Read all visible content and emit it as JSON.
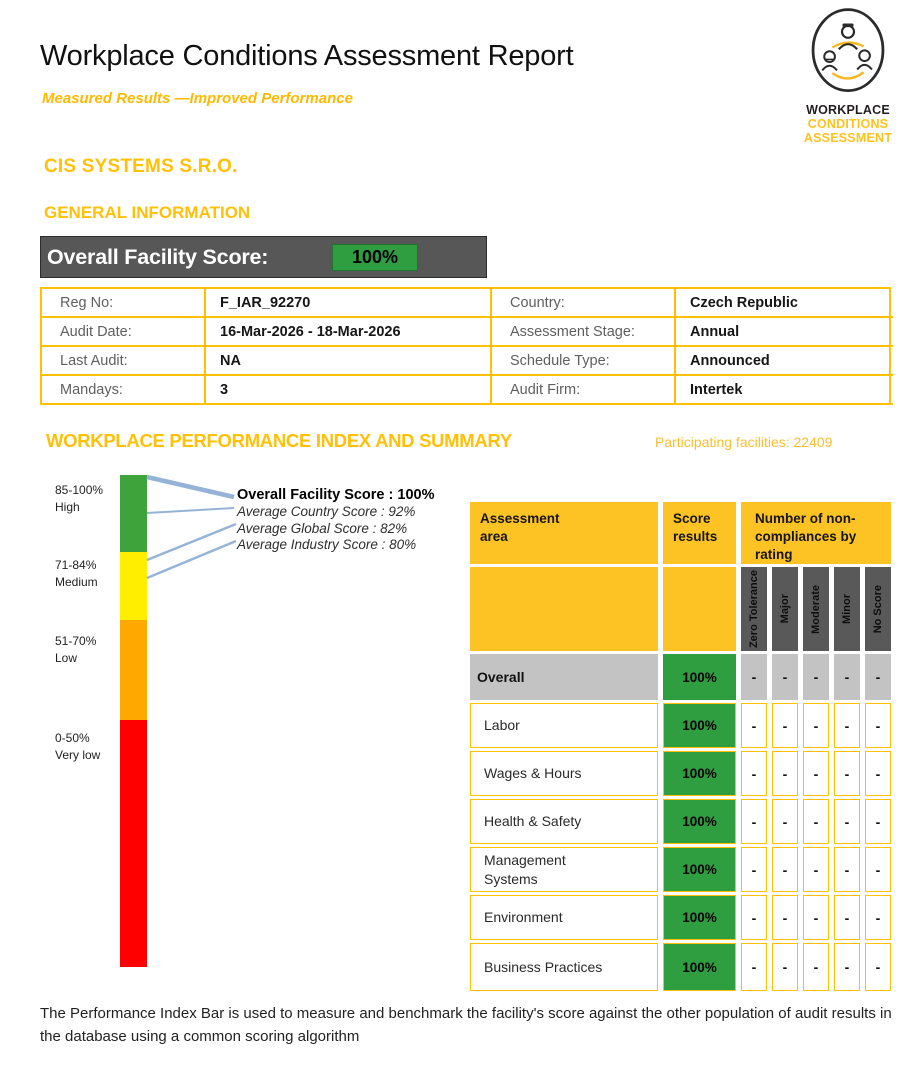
{
  "header": {
    "title": "Workplace Conditions Assessment Report",
    "subtitle": "Measured Results —Improved Performance",
    "logo": {
      "line1": "WORKPLACE",
      "line2": "CONDITIONS",
      "line3": "ASSESSMENT"
    }
  },
  "company_name": "CIS SYSTEMS S.R.O.",
  "general_information": {
    "section_title": "GENERAL INFORMATION",
    "overall_score": {
      "label": "Overall Facility Score:",
      "value": "100%"
    },
    "rows": [
      {
        "left_label": "Reg No:",
        "left_value": "F_IAR_92270",
        "right_label": "Country:",
        "right_value": "Czech Republic"
      },
      {
        "left_label": "Audit Date:",
        "left_value": "16-Mar-2026 - 18-Mar-2026",
        "right_label": "Assessment Stage:",
        "right_value": "Annual"
      },
      {
        "left_label": "Last Audit:",
        "left_value": "NA",
        "right_label": "Schedule Type:",
        "right_value": "Announced"
      },
      {
        "left_label": "Mandays:",
        "left_value": "3",
        "right_label": "Audit Firm:",
        "right_value": "Intertek"
      }
    ]
  },
  "performance_index": {
    "section_title": "WORKPLACE PERFORMANCE INDEX AND SUMMARY",
    "participating_facilities": "Participating facilities: 22409",
    "bands": [
      {
        "range": "85-100%",
        "label": "High",
        "color": "#3FA33C"
      },
      {
        "range": "71-84%",
        "label": "Medium",
        "color": "#FFEE00"
      },
      {
        "range": "51-70%",
        "label": "Low",
        "color": "#FFA800"
      },
      {
        "range": "0-50%",
        "label": "Very low",
        "color": "#FE0000"
      }
    ],
    "callouts": {
      "overall": "Overall Facility Score : 100%",
      "country": "Average Country Score : 92%",
      "global": "Average Global Score : 82%",
      "industry": "Average Industry Score : 80%"
    },
    "note_line1": "The Performance Index Bar is used to measure and benchmark the facility's score against the other population of audit results in",
    "note_line2": "the database using a common scoring algorithm"
  },
  "summary_table": {
    "headers": {
      "area": "Assessment\narea",
      "score": "Score\nresults",
      "noncompliance": "Number of non-\ncompliances by\nrating"
    },
    "rating_columns": [
      "Zero Tolerance",
      "Major",
      "Moderate",
      "Minor",
      "No Score"
    ],
    "rows": [
      {
        "area": "Overall",
        "score": "100%",
        "ratings": [
          "-",
          "-",
          "-",
          "-",
          "-"
        ]
      },
      {
        "area": "Labor",
        "score": "100%",
        "ratings": [
          "-",
          "-",
          "-",
          "-",
          "-"
        ]
      },
      {
        "area": "Wages & Hours",
        "score": "100%",
        "ratings": [
          "-",
          "-",
          "-",
          "-",
          "-"
        ]
      },
      {
        "area": "Health & Safety",
        "score": "100%",
        "ratings": [
          "-",
          "-",
          "-",
          "-",
          "-"
        ]
      },
      {
        "area": "Management\nSystems",
        "score": "100%",
        "ratings": [
          "-",
          "-",
          "-",
          "-",
          "-"
        ]
      },
      {
        "area": "Environment",
        "score": "100%",
        "ratings": [
          "-",
          "-",
          "-",
          "-",
          "-"
        ]
      },
      {
        "area": "Business Practices",
        "score": "100%",
        "ratings": [
          "-",
          "-",
          "-",
          "-",
          "-"
        ]
      }
    ]
  },
  "colors": {
    "accent_gold": "#FFC000",
    "table_header_yellow": "#FDC324",
    "score_green": "#2F9E40",
    "score_bar_gray": "#575757",
    "rating_header_gray": "#595959",
    "overall_row_gray": "#C3C3C3",
    "callout_line_blue": "#95B3D7"
  }
}
